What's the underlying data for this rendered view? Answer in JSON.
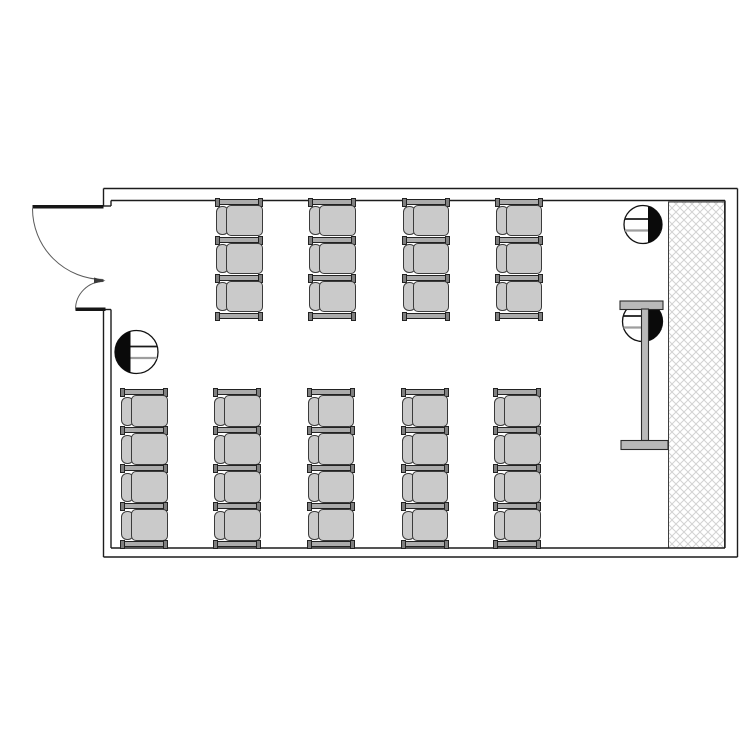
{
  "plan": {
    "description": "architectural-floor-plan-classroom",
    "canvas": {
      "width": 750,
      "height": 750,
      "background": "#ffffff"
    },
    "palette": {
      "wall_line": "#1c1c1c",
      "arc_line": "#5a5a5a",
      "door_leaf": "#161616",
      "seat_fill": "#cacaca",
      "seat_stroke": "#3b3b3b",
      "rail_fill": "#ababab",
      "rail_stroke": "#222222",
      "rail_cap_fill": "#7f7f7f",
      "hatch_line": "#d2d2d2",
      "hatch_border": "#3f3f3f",
      "screen_fill": "#b9b9b9",
      "screen_stroke": "#2a2a2a",
      "marker_fill": "#ffffff",
      "marker_stroke": "#111111",
      "marker_segment": "#0a0a0a",
      "marker_line_dark": "#1a1a1a",
      "marker_line_grey": "#9e9e9e"
    },
    "room": {
      "outer": {
        "x": 103.5,
        "y": 188.5,
        "w": 634,
        "h": 368.5
      },
      "inner": {
        "x": 111,
        "y": 200.5,
        "w": 614,
        "h": 347.5
      },
      "door_opening": {
        "wall": "left",
        "y1": 206,
        "y2": 309.5
      }
    },
    "door": {
      "type": "unequal-double-swing-outward",
      "leaf1": {
        "hinge_x": 103.5,
        "hinge_y": 208.5,
        "length": 71,
        "line_y": 205,
        "line_h": 3.5
      },
      "leaf2": {
        "hinge_x": 103.5,
        "hinge_y": 309.5,
        "length": 28,
        "line_y": 307.5,
        "line_h": 3.5
      },
      "meet_wedge": "M 94 277.5 L 105.5 280.8 L 94 283.5 Z"
    },
    "hatch_panel": {
      "x": 668.5,
      "y": 202,
      "w": 56,
      "h": 346,
      "pattern": "diagonal-crosshatch",
      "cell": 8
    },
    "projection_screen": {
      "top_bar": {
        "x": 620,
        "y": 301,
        "w": 43,
        "h": 8.5
      },
      "stem": {
        "x": 641.5,
        "y": 309,
        "w": 7,
        "h": 131.5
      },
      "bottom_bar": {
        "x": 621,
        "y": 440.5,
        "w": 47,
        "h": 9
      }
    },
    "markers": [
      {
        "cx": 136.5,
        "cy": 352,
        "r": 21.5,
        "shaded_side": "left",
        "chord_offset": 6
      },
      {
        "cx": 643,
        "cy": 224.5,
        "r": 19,
        "shaded_side": "right",
        "chord_offset": 5
      },
      {
        "cx": 642.5,
        "cy": 321.5,
        "r": 20,
        "shaded_side": "right",
        "chord_offset": 6
      }
    ],
    "seating": {
      "chair": {
        "width": 48,
        "rail_h": 5.5,
        "seat_h": 32.5,
        "pitch": 38,
        "back_w": 13,
        "facing": "right"
      },
      "groups": [
        {
          "name": "front-block",
          "start_y": 198.5,
          "seats_per_column": 3,
          "columns_x": [
            215,
            308,
            401.5,
            494.5
          ]
        },
        {
          "name": "rear-block",
          "start_y": 389,
          "seats_per_column": 4,
          "columns_x": [
            120,
            213,
            306.5,
            400.5,
            493
          ]
        }
      ],
      "total_seats": 32
    }
  }
}
